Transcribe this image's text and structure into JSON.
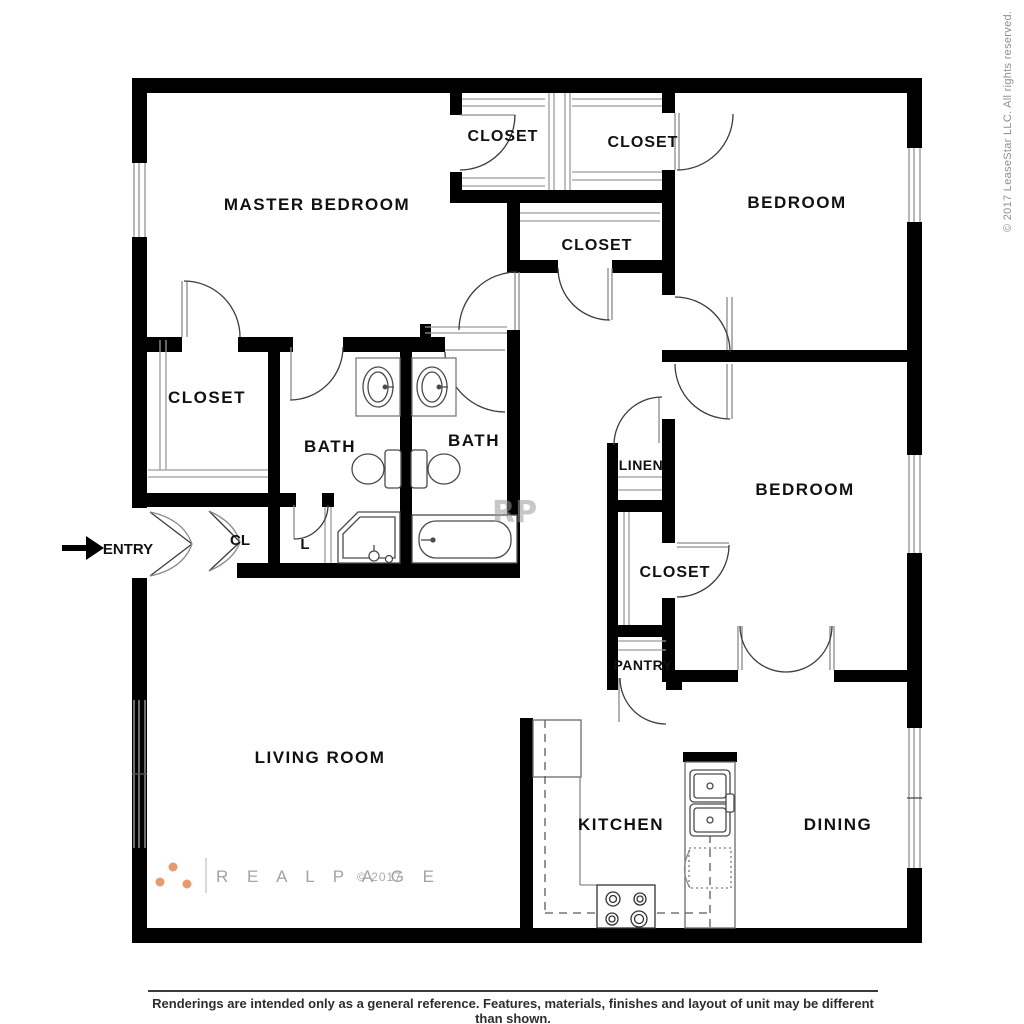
{
  "labels": {
    "master_bedroom": "MASTER BEDROOM",
    "closet_master_top": "CLOSET",
    "closet_hall_top": "CLOSET",
    "closet_hall": "CLOSET",
    "bedroom_top": "BEDROOM",
    "closet_master": "CLOSET",
    "bath_1": "BATH",
    "bath_2": "BATH",
    "cl": "CL",
    "l": "L",
    "entry": "ENTRY",
    "linen": "LINEN",
    "bedroom_right": "BEDROOM",
    "closet_bedroom": "CLOSET",
    "pantry": "PANTRY",
    "living_room": "LIVING ROOM",
    "kitchen": "KITCHEN",
    "dining": "DINING"
  },
  "branding": {
    "logo": "R E A L P A G E",
    "year": "© 2017",
    "watermark": "RP",
    "dot_color": "#e89a6e"
  },
  "side_copyright": "© 2017 LeaseStar LLC. All rights reserved.",
  "footer": {
    "disclaimer": "Renderings are intended only as a general reference. Features, materials, finishes and layout of unit may be different than shown."
  },
  "colors": {
    "wall": "#000000",
    "fixture_line": "#4a4a4a",
    "thin_line": "#9a9a9a"
  }
}
